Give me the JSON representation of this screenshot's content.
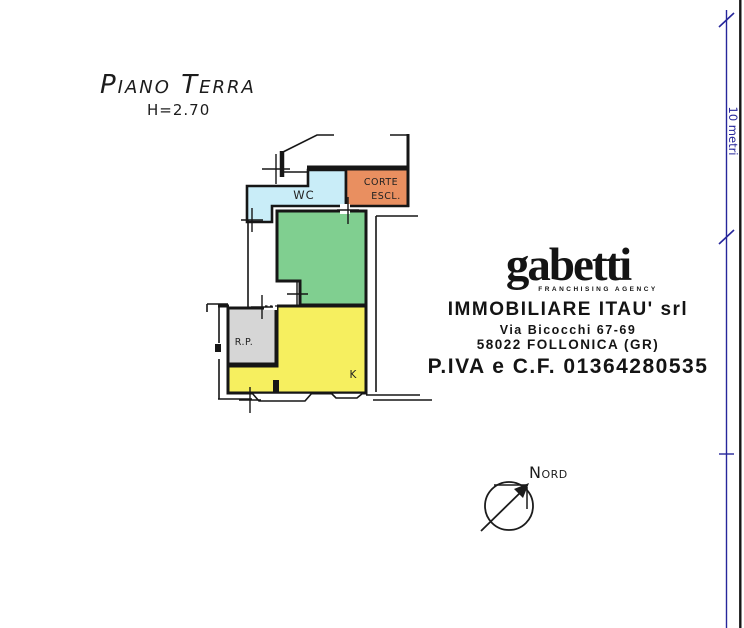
{
  "title_block": {
    "title": "Piano Terra",
    "height": "H=2.70"
  },
  "plan": {
    "rooms": {
      "wc": {
        "label": "WC",
        "color": "#c9edf8"
      },
      "corte": {
        "label_line1": "CORTE",
        "label_line2": "ESCL.",
        "color": "#e98f60"
      },
      "living": {
        "color": "#80cf90"
      },
      "rp": {
        "label": "R.P.",
        "color": "#d6d6d6"
      },
      "kitchen": {
        "label": "K",
        "color": "#f6ef5f"
      }
    }
  },
  "stamp": {
    "logo": "gabetti",
    "logo_tagline": "FRANCHISING AGENCY",
    "company": "IMMOBILIARE ITAU' srl",
    "address": "Via Bicocchi 67-69",
    "city": "58022 FOLLONICA (GR)",
    "vat": "P.IVA e C.F. 01364280535"
  },
  "compass": {
    "label": "Nord"
  },
  "scale_bar": {
    "label": "10 metri",
    "color": "#26269b"
  }
}
